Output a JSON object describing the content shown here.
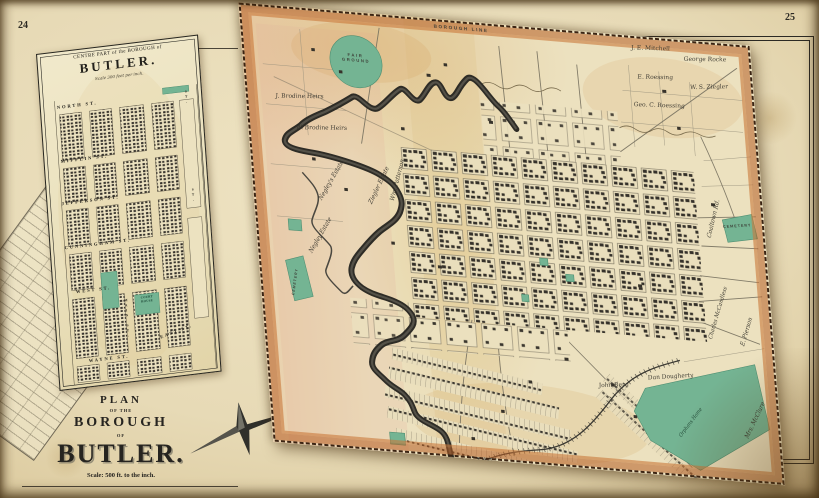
{
  "palette": {
    "paper": "#e7dab4",
    "map_paper": "#ece1bf",
    "border_orange": "#b65f24",
    "ink": "#2c2a24",
    "water": "#2e2c26",
    "green": "#74b493"
  },
  "page": {
    "left_number": "24",
    "right_number": "25"
  },
  "inset": {
    "title_top": "CENTRE PART of the BOROUGH of",
    "title_main": "BUTLER.",
    "scale_note": "Scale 300 feet per inch.",
    "streets": {
      "north": "NORTH ST.",
      "mifflin": "MIFFLIN ST.",
      "jefferson": "JEFFERSON ST.",
      "cunningham": "CUNNINGHAM ST.",
      "west": "WEST ST.",
      "wayne": "WAYNE ST.",
      "east": "EAST ST.",
      "main": "MAIN ST.",
      "st_right_top": "ST.",
      "st_right_mid": "ST."
    },
    "landmarks": {
      "court_house": "COURT HOUSE"
    }
  },
  "title_block": {
    "plan": "PLAN",
    "of_the": "OF THE",
    "borough": "BOROUGH",
    "of": "OF",
    "name": "BUTLER.",
    "scale": "Scale: 500 ft. to the inch."
  },
  "main_map": {
    "labels": [
      {
        "id": "borough-line",
        "text": "BOROUGH LINE"
      },
      {
        "id": "fair-ground",
        "text": "FAIR GROUND"
      },
      {
        "id": "j-brodine-heirs",
        "text": "J. Brodine Heirs"
      },
      {
        "id": "w-brodine-heirs",
        "text": "W. Brodine Heirs"
      },
      {
        "id": "negleys-estate-1",
        "text": "Negley's Estate"
      },
      {
        "id": "negleys-estate-2",
        "text": "Negley Estate"
      },
      {
        "id": "ziegler-estate",
        "text": "Ziegler Estate"
      },
      {
        "id": "wm-patterson",
        "text": "Wm. Patterson"
      },
      {
        "id": "je-mitchell",
        "text": "J. E. Mitchell"
      },
      {
        "id": "george-rocke",
        "text": "George Rocke"
      },
      {
        "id": "e-roessing",
        "text": "E. Roessing"
      },
      {
        "id": "ws-ziegler",
        "text": "W. S. Ziegler"
      },
      {
        "id": "geo-c-roessing",
        "text": "Geo. C. Roessing"
      },
      {
        "id": "coaltown-rd",
        "text": "Coaltown Rd."
      },
      {
        "id": "cemetery-east",
        "text": "CEMETERY"
      },
      {
        "id": "charles-mccandless",
        "text": "Charles McCandless"
      },
      {
        "id": "e-pierson",
        "text": "E. Pierson"
      },
      {
        "id": "mrs-mcclure",
        "text": "Mrs. McClure"
      },
      {
        "id": "john-berg",
        "text": "John Berg"
      },
      {
        "id": "dan-dougherty",
        "text": "Dan Dougherty"
      },
      {
        "id": "orphans-home",
        "text": "Orphans Home"
      },
      {
        "id": "cemetery-west",
        "text": "CEMETERY"
      }
    ]
  }
}
